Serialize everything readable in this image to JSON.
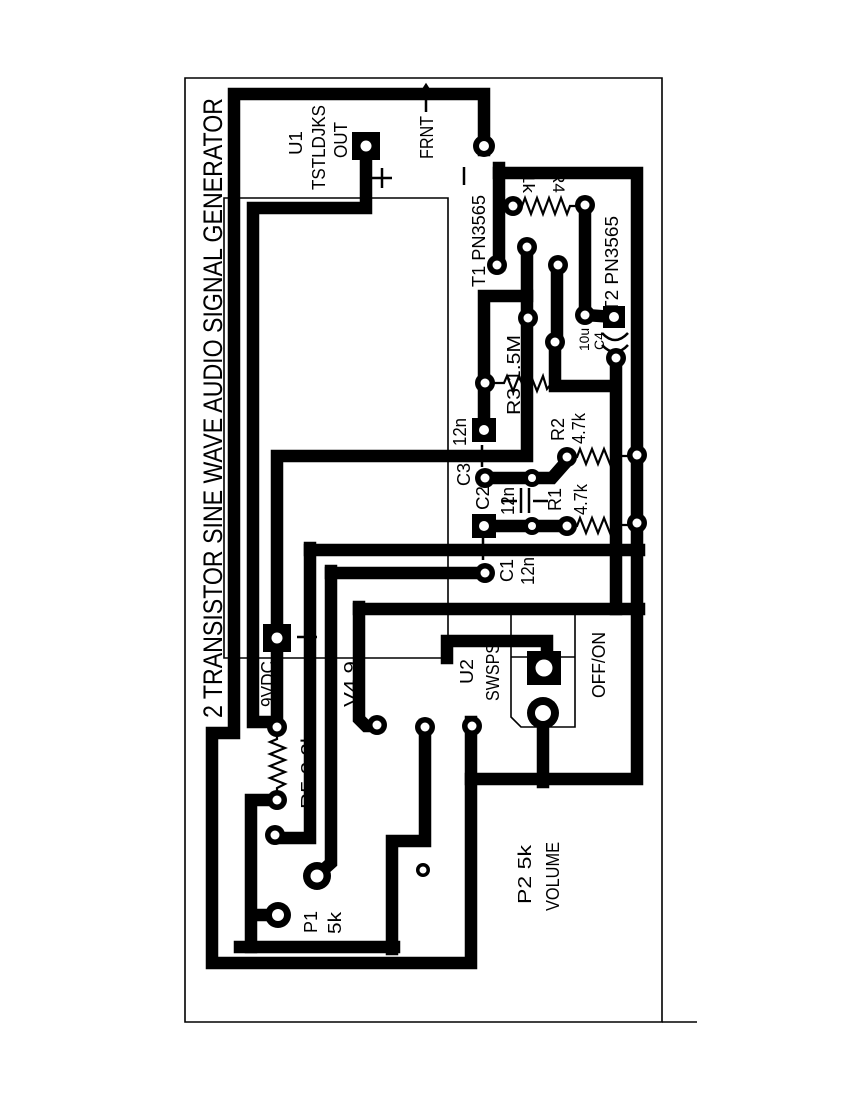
{
  "page_title": "2 TRANSISTOR SINE WAVE AUDIO SIGNAL GENERATOR",
  "colors": {
    "trace": "#000000",
    "board": "#ffffff",
    "silkscreen": "#000000"
  },
  "diagram": {
    "kind": "pcb-layout",
    "board_title": {
      "text": "2 TRANSISTOR SINE WAVE AUDIO SIGNAL GENERATOR",
      "x": 222,
      "y": 718,
      "size": 27,
      "len": 620
    },
    "labels": [
      {
        "t": "U1",
        "x": 302,
        "y": 155,
        "s": 18,
        "len": 24
      },
      {
        "t": "TSTLDJKS",
        "x": 325,
        "y": 190,
        "s": 18,
        "len": 85
      },
      {
        "t": "OUT",
        "x": 347,
        "y": 158,
        "s": 18,
        "len": 36
      },
      {
        "t": "FRNT",
        "x": 433,
        "y": 159,
        "s": 18,
        "len": 43
      },
      {
        "t": "T1 PN3565",
        "x": 485,
        "y": 287,
        "s": 18,
        "len": 92
      },
      {
        "t": "T2 PN3565",
        "x": 618,
        "y": 312,
        "s": 18,
        "len": 96
      },
      {
        "t": "R4",
        "x": 553,
        "y": 171,
        "s": 17,
        "rot": 90,
        "len": 22
      },
      {
        "t": "1k",
        "x": 523,
        "y": 173,
        "s": 17,
        "rot": 90,
        "len": 20
      },
      {
        "t": "10u",
        "x": 589,
        "y": 351,
        "s": 14,
        "len": 23
      },
      {
        "t": "C4",
        "x": 604,
        "y": 350,
        "s": 14,
        "len": 18
      },
      {
        "t": "R3 1.5M",
        "x": 520,
        "y": 415,
        "s": 18,
        "len": 80
      },
      {
        "t": "12n",
        "x": 466,
        "y": 446,
        "s": 18,
        "len": 28
      },
      {
        "t": "C3",
        "x": 470,
        "y": 486,
        "s": 18,
        "len": 23
      },
      {
        "t": "C2",
        "x": 489,
        "y": 510,
        "s": 18,
        "len": 24
      },
      {
        "t": "12n",
        "x": 514,
        "y": 515,
        "s": 18,
        "len": 28
      },
      {
        "t": "R1",
        "x": 561,
        "y": 511,
        "s": 18,
        "len": 23
      },
      {
        "t": "4.7k",
        "x": 587,
        "y": 515,
        "s": 18,
        "len": 31
      },
      {
        "t": "R2",
        "x": 564,
        "y": 441,
        "s": 18,
        "len": 23
      },
      {
        "t": "4.7k",
        "x": 585,
        "y": 444,
        "s": 18,
        "len": 31
      },
      {
        "t": "C1",
        "x": 513,
        "y": 582,
        "s": 18,
        "len": 23
      },
      {
        "t": "12n",
        "x": 534,
        "y": 585,
        "s": 18,
        "len": 28
      },
      {
        "t": "9VDC",
        "x": 274,
        "y": 707,
        "s": 18,
        "len": 46
      },
      {
        "t": "V4.9",
        "x": 357,
        "y": 707,
        "s": 18,
        "len": 46
      },
      {
        "t": "U2",
        "x": 473,
        "y": 684,
        "s": 18,
        "len": 25
      },
      {
        "t": "SWSPS",
        "x": 499,
        "y": 701,
        "s": 18,
        "len": 58
      },
      {
        "t": "OFF/ON",
        "x": 605,
        "y": 698,
        "s": 18,
        "len": 66
      },
      {
        "t": "R5 2.2k",
        "x": 314,
        "y": 809,
        "s": 18,
        "len": 77
      },
      {
        "t": "P1",
        "x": 317,
        "y": 933,
        "s": 18,
        "len": 22
      },
      {
        "t": "5k",
        "x": 341,
        "y": 934,
        "s": 18,
        "len": 22
      },
      {
        "t": "P2 5k",
        "x": 531,
        "y": 904,
        "s": 18,
        "len": 59
      },
      {
        "t": "VOLUME",
        "x": 559,
        "y": 911,
        "s": 18,
        "len": 69
      }
    ],
    "outlines": [
      {
        "name": "board-outline",
        "d": "M185,78 H662 V1022 H185 Z"
      },
      {
        "name": "u1-module-outline",
        "d": "M224,198 H448 V658 H224 Z"
      },
      {
        "name": "u2-switch-outline",
        "d": "M511,612 V717 L521,727 H575 V612"
      },
      {
        "name": "u2-switch-line",
        "d": "M511,657 H575"
      },
      {
        "name": "frame-extension",
        "d": "M662,1022 H697"
      }
    ],
    "traces": [
      {
        "name": "ground-loop",
        "d": "M484,150 V94 H234 V733 H212 V963 H471 V722"
      },
      {
        "name": "ground-right-rail",
        "d": "M471,779 H637 V173 H499"
      },
      {
        "name": "t1-collector-trace",
        "d": "M499,168 V265 M499,206 H509"
      },
      {
        "name": "p2-wiper-trace",
        "d": "M543,710 V782"
      },
      {
        "name": "supply-rail",
        "d": "M366,150 V208 H253 V722 H277 V456 H527 V247"
      },
      {
        "name": "c3-branch",
        "d": "M527,296 H484 V430"
      },
      {
        "name": "t2-trace",
        "d": "M585,203 V315 M585,315 L614,317"
      },
      {
        "name": "c4-r3-net",
        "d": "M557,264 V342 M555,342 V386 H616 M616,356 V609"
      },
      {
        "name": "c2-r1-rail",
        "d": "M482,526 H567"
      },
      {
        "name": "c3-r2-rail",
        "d": "M483,478 H552 L567,461"
      },
      {
        "name": "mid-rail-549",
        "d": "M310,550 H639"
      },
      {
        "name": "c1-rail-573",
        "d": "M331,573 H487"
      },
      {
        "name": "mid-rail-609",
        "d": "M359,609 H639"
      },
      {
        "name": "switch-trace",
        "d": "M447,641 H547 V655 M447,641 V658"
      },
      {
        "name": "p1-wiper-riser",
        "d": "M310,548 V838 H277"
      },
      {
        "name": "p1-pin-riser",
        "d": "M331,571 V863 L321,872 L317,877"
      },
      {
        "name": "pad-riser-359",
        "d": "M359,607 V719 L366,726 H378"
      },
      {
        "name": "pad-riser-425",
        "d": "M425,725 V841 H392 V949 M240,947 H394"
      },
      {
        "name": "r5-p1-link",
        "d": "M273,800 H251 V947 M251,915 H279"
      }
    ],
    "zigzags": [
      {
        "name": "resistor-r4",
        "d": "M506,206 H522 L525,198 L531,214 L537,198 L543,214 L549,198 L555,214 L561,198 L567,214 L570,206 H584"
      },
      {
        "name": "resistor-r2",
        "d": "M570,457 H577 L580,449 L586,464 L592,449 L598,464 L604,449 L610,464 L613,456 H630"
      },
      {
        "name": "resistor-r1",
        "d": "M570,526 H577 L580,518 L586,533 L592,518 L598,533 L604,518 L610,533 L613,525 H630"
      },
      {
        "name": "resistor-r3",
        "d": "M492,383 H504 L507,376 L513,391 L519,376 L525,391 L531,376 L537,391 L543,376 L547,389 L551,384 L560,386"
      },
      {
        "name": "resistor-r5",
        "d": "M277,730 V739 L270,742 L285,748 L270,754 L285,760 L270,766 L285,772 L270,778 L285,784 L277,788 V797"
      }
    ],
    "symbols": [
      {
        "name": "capacitor-c2-lead-left",
        "d": "M502,501 H517"
      },
      {
        "name": "capacitor-c2-plate-1",
        "d": "M521,488 V513"
      },
      {
        "name": "capacitor-c2-plate-2",
        "d": "M529,488 V513"
      },
      {
        "name": "capacitor-c2-lead-right",
        "d": "M533,501 H548"
      },
      {
        "name": "capacitor-c4-plate-1",
        "d": "M602,333 Q615,347 628,333"
      },
      {
        "name": "capacitor-c4-plate-2",
        "d": "M602,345 Q615,359 628,345"
      },
      {
        "name": "plus-mark-out",
        "d": "M372,178 H392 M382,168 V188"
      },
      {
        "name": "minus-mark-frnt",
        "d": "M464,167 V185"
      },
      {
        "name": "plus-mark-c3",
        "d": "M482,445 V467 M471,456 H493"
      },
      {
        "name": "plus-mark-c1",
        "d": "M483,538 V560 M472,549 H494"
      },
      {
        "name": "plus-mark-9vdc",
        "d": "M297,637 H317 M307,627 V647"
      },
      {
        "name": "frnt-arrow",
        "d": "M426,86 V112 M417,99 L426,85 L435,99"
      }
    ],
    "square_pads": [
      {
        "name": "pad-u1-out",
        "x": 366,
        "y": 146,
        "size": 28,
        "hole": 5.5
      },
      {
        "name": "pad-9vdc",
        "x": 277,
        "y": 638,
        "size": 28,
        "hole": 5.5
      },
      {
        "name": "pad-c3",
        "x": 484,
        "y": 430,
        "size": 24,
        "hole": 5
      },
      {
        "name": "pad-c2",
        "x": 484,
        "y": 526,
        "size": 24,
        "hole": 5
      },
      {
        "name": "pad-t2-e",
        "x": 614,
        "y": 317,
        "size": 22,
        "hole": 5
      },
      {
        "name": "pad-switch",
        "x": 544,
        "y": 668,
        "size": 34,
        "hole": 8.5
      }
    ],
    "round_pads": [
      {
        "name": "pad-frnt",
        "x": 484,
        "y": 146,
        "r": 11,
        "hole": 5
      },
      {
        "name": "pad-t1-c",
        "x": 497,
        "y": 265,
        "r": 10,
        "hole": 4.5
      },
      {
        "name": "pad-r4-left",
        "x": 513,
        "y": 206,
        "r": 10,
        "hole": 4.5
      },
      {
        "name": "pad-r4-t2",
        "x": 585,
        "y": 205,
        "r": 10,
        "hole": 4.5
      },
      {
        "name": "pad-t1-b",
        "x": 527,
        "y": 247,
        "r": 10,
        "hole": 4.5
      },
      {
        "name": "pad-t2-b",
        "x": 558,
        "y": 265,
        "r": 10,
        "hole": 4.5
      },
      {
        "name": "pad-t1-e",
        "x": 528,
        "y": 318,
        "r": 10,
        "hole": 4.5
      },
      {
        "name": "pad-t2-c",
        "x": 585,
        "y": 315,
        "r": 10,
        "hole": 4.5
      },
      {
        "name": "pad-r3-right",
        "x": 555,
        "y": 342,
        "r": 10,
        "hole": 4.5
      },
      {
        "name": "pad-c4",
        "x": 616,
        "y": 358,
        "r": 10,
        "hole": 4.5
      },
      {
        "name": "pad-r3-left",
        "x": 485,
        "y": 383,
        "r": 10,
        "hole": 4.5
      },
      {
        "name": "pad-rail-r2",
        "x": 637,
        "y": 455,
        "r": 10,
        "hole": 4.5
      },
      {
        "name": "pad-rail-r1",
        "x": 637,
        "y": 523,
        "r": 10,
        "hole": 4.5
      },
      {
        "name": "pad-c3-mid",
        "x": 532,
        "y": 478,
        "r": 9,
        "hole": 4
      },
      {
        "name": "pad-r2-left",
        "x": 567,
        "y": 457,
        "r": 10,
        "hole": 4.5
      },
      {
        "name": "pad-c2-mid",
        "x": 532,
        "y": 526,
        "r": 9,
        "hole": 4
      },
      {
        "name": "pad-r1-left",
        "x": 567,
        "y": 526,
        "r": 10,
        "hole": 4.5
      },
      {
        "name": "pad-c3-round",
        "x": 485,
        "y": 478,
        "r": 10,
        "hole": 4.5
      },
      {
        "name": "pad-c1",
        "x": 485,
        "y": 573,
        "r": 10,
        "hole": 4.5
      },
      {
        "name": "pad-377",
        "x": 377,
        "y": 725,
        "r": 10,
        "hole": 4.5
      },
      {
        "name": "pad-425",
        "x": 425,
        "y": 727,
        "r": 10,
        "hole": 4.5
      },
      {
        "name": "pad-472",
        "x": 472,
        "y": 726,
        "r": 10,
        "hole": 4.5
      },
      {
        "name": "pad-r5-top",
        "x": 277,
        "y": 727,
        "r": 10,
        "hole": 4.5
      },
      {
        "name": "pad-r5-bot",
        "x": 277,
        "y": 800,
        "r": 10,
        "hole": 4.5
      },
      {
        "name": "pad-p1-wiper",
        "x": 275,
        "y": 835,
        "r": 10,
        "hole": 4.5
      },
      {
        "name": "pad-p1-a",
        "x": 278,
        "y": 915,
        "r": 13,
        "hole": 6
      },
      {
        "name": "pad-p1-b",
        "x": 317,
        "y": 876,
        "r": 14,
        "hole": 6.5
      },
      {
        "name": "pad-p2-wiper",
        "x": 543,
        "y": 713,
        "r": 16,
        "hole": 8
      },
      {
        "name": "pad-lone",
        "x": 423,
        "y": 870,
        "r": 7,
        "hole": 3.5
      }
    ]
  }
}
